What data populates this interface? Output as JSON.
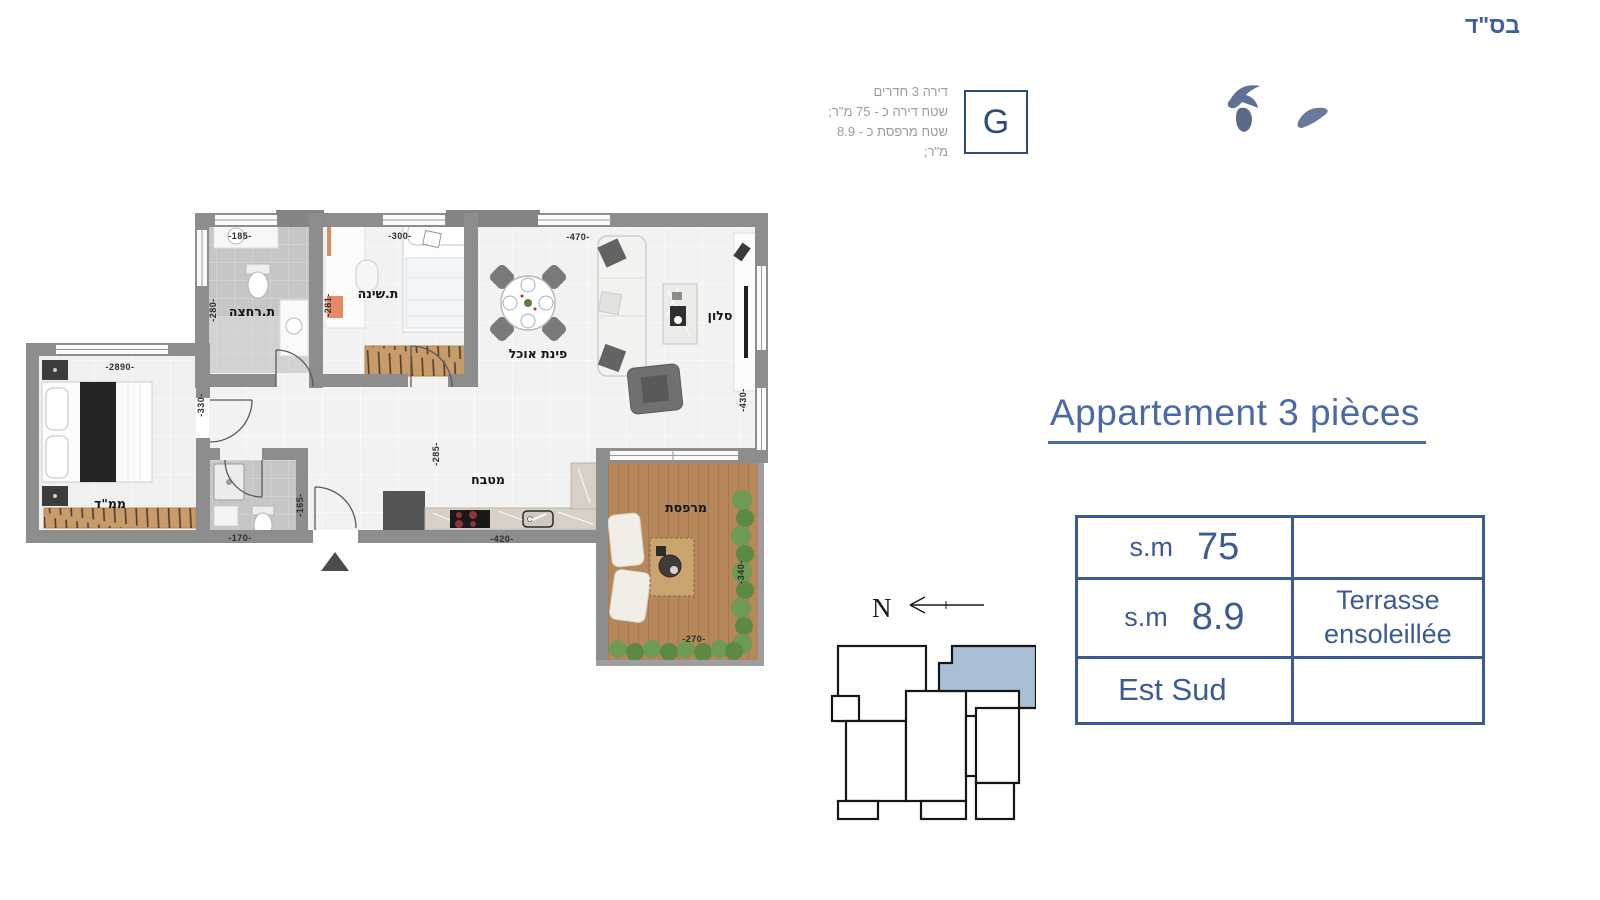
{
  "bsd": "בס\"ד",
  "header": {
    "unit_letter": "G",
    "lines": [
      "דירה 3 חדרים",
      "שטח דירה כ - 75 מ\"ר;",
      "שטח מרפסת כ - 8.9 מ\"ר;"
    ]
  },
  "title": "Appartement 3 pièces",
  "table": {
    "rows": [
      {
        "label": "s.m",
        "value": "75",
        "note": ""
      },
      {
        "label": "s.m",
        "value": "8.9",
        "note": "Terrasse ensoleillée"
      },
      {
        "label": "Est Sud",
        "value": "",
        "note": ""
      }
    ]
  },
  "compass": {
    "label": "N"
  },
  "floorplan": {
    "rooms": {
      "bathroom": "ת.רחצה",
      "bedroom": "ת.שינה",
      "dining": "פינת אוכל",
      "living": "סלון",
      "mamad": "ממ\"ד",
      "kitchen": "מטבח",
      "balcony": "מרפסת"
    },
    "dims": {
      "top_bathroom": "-185-",
      "top_bedroom": "-300-",
      "top_living": "-470-",
      "left_bathroom": "-280-",
      "left_bedroom": "-281-",
      "mamad_width": "-2890-",
      "hall_height": "-330-",
      "living_right": "-430-",
      "hall_center": "-285-",
      "kitchen_width": "-420-",
      "wc_height": "-165-",
      "wc_width": "-170-",
      "balcony_height": "-340-",
      "balcony_width": "-270-"
    }
  },
  "colors": {
    "accent_navy": "#3b5a96",
    "title_blue": "#4a69a6",
    "keyplan_highlight": "#a9bfd6",
    "wall_gray": "#8d8d8d",
    "wood": "#b5875a"
  }
}
